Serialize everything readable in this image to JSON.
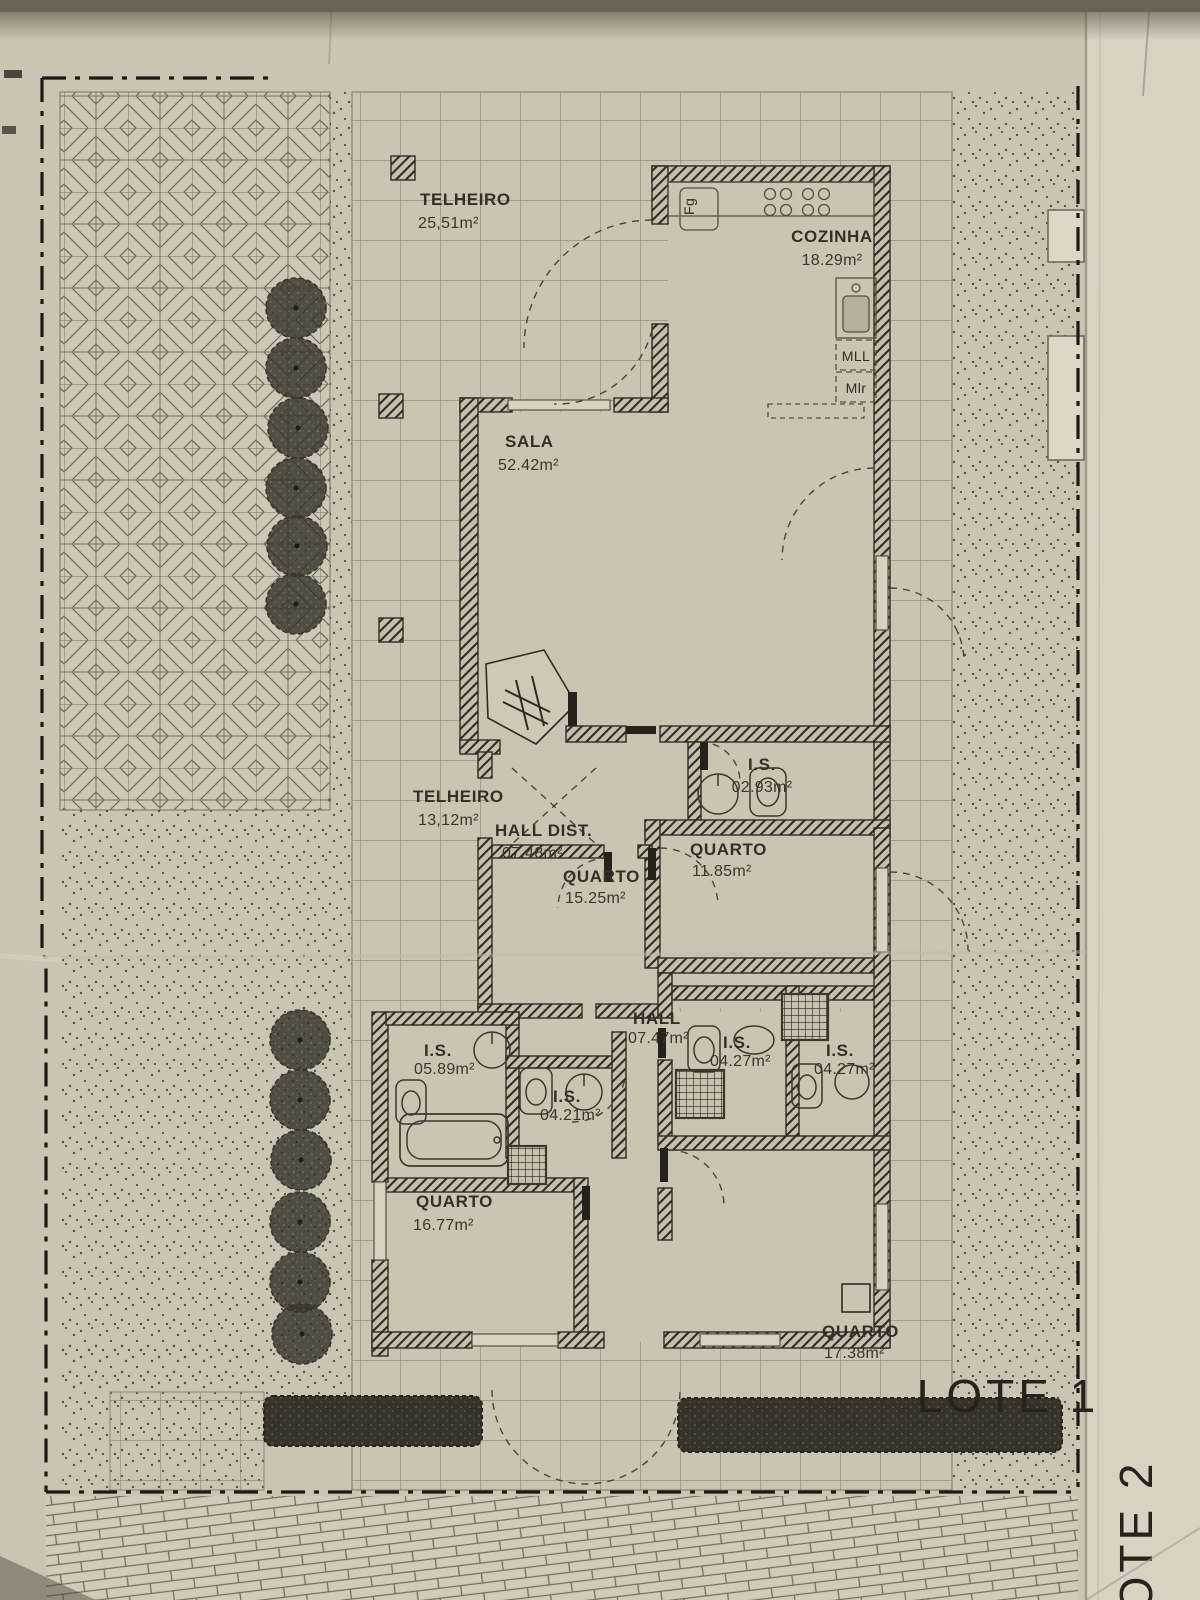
{
  "sheet": {
    "kind": "house floor plan photograph",
    "lot_label_main": "LOTE 1",
    "lot_label_side": "LOTE 2"
  },
  "labels": {
    "lote1": "LOTE 1",
    "lote2": "LOTE 2"
  },
  "rooms": [
    {
      "id": "telheiro-top",
      "name": "TELHEIRO",
      "area": "25,51m²"
    },
    {
      "id": "cozinha",
      "name": "COZINHA",
      "area": "18.29m²"
    },
    {
      "id": "sala",
      "name": "SALA",
      "area": "52.42m²"
    },
    {
      "id": "is-top",
      "name": "I.S.",
      "area": "02.93m²"
    },
    {
      "id": "telheiro-mid",
      "name": "TELHEIRO",
      "area": "13,12m²"
    },
    {
      "id": "hall-dist",
      "name": "HALL DIST.",
      "area": "07.48m²"
    },
    {
      "id": "quarto-1525",
      "name": "QUARTO",
      "area": "15.25m²"
    },
    {
      "id": "quarto-1185",
      "name": "QUARTO",
      "area": "11.85m²"
    },
    {
      "id": "hall",
      "name": "HALL",
      "area": "07.47m²"
    },
    {
      "id": "is-0589",
      "name": "I.S.",
      "area": "05.89m²"
    },
    {
      "id": "is-0421",
      "name": "I.S.",
      "area": "04.21m²"
    },
    {
      "id": "is-0427a",
      "name": "I.S.",
      "area": "04.27m²"
    },
    {
      "id": "is-0427b",
      "name": "I.S.",
      "area": "04.27m²"
    },
    {
      "id": "quarto-1677",
      "name": "QUARTO",
      "area": "16.77m²"
    },
    {
      "id": "quarto-1738",
      "name": "QUARTO",
      "area": "17.38m²"
    }
  ],
  "appliances": {
    "dishwasher": "MLL",
    "washer": "Mlr",
    "fridge": "Fg"
  },
  "colors": {
    "paper": "#ccc4b2",
    "paper_light": "#d9d2c3",
    "ink": "#2f2b23",
    "line": "#56503f"
  }
}
